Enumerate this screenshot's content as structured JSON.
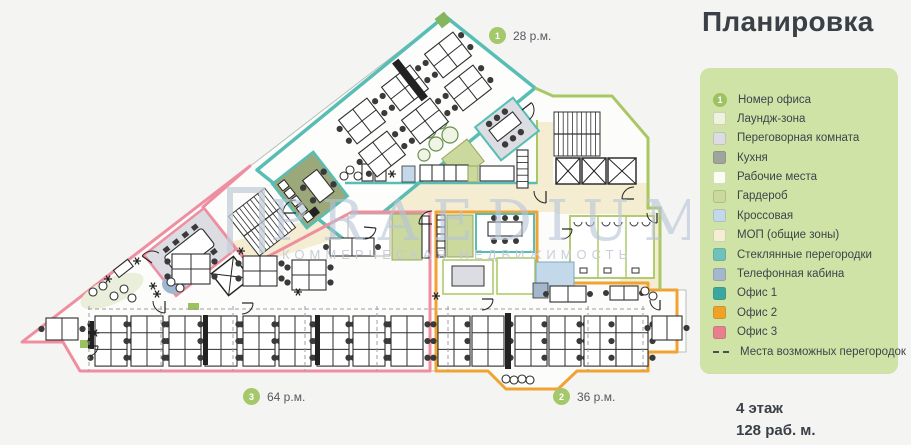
{
  "title": "Планировка",
  "floor_info": {
    "floor": "4 этаж",
    "capacity": "128 раб. м."
  },
  "plan_labels": [
    {
      "num": "1",
      "text": "28 р.м."
    },
    {
      "num": "2",
      "text": "36 р.м."
    },
    {
      "num": "3",
      "text": "64 р.м."
    }
  ],
  "watermark": {
    "brand": "PRAEDIUM",
    "tagline": "КОММЕРЧЕСКАЯ НЕДВИЖИМОСТЬ"
  },
  "colors": {
    "office1_teal": "#57bdb5",
    "office2_orange": "#f0a233",
    "office3_pink": "#ef8ea0",
    "core_green": "#a9c763",
    "corridor_beige": "#f5edd2",
    "legend_bg": "#cee3a5",
    "badge_green": "#a5c86b",
    "text_dark": "#3a4046"
  },
  "legend": {
    "items": [
      {
        "type": "circle",
        "color": "#9dc163",
        "text": "1",
        "label": "Номер офиса"
      },
      {
        "type": "rect",
        "color": "#eef3dd",
        "label": "Лаундж-зона"
      },
      {
        "type": "rect",
        "color": "#dcdde2",
        "label": "Переговорная комната"
      },
      {
        "type": "rect",
        "color": "#9fa49c",
        "label": "Кухня"
      },
      {
        "type": "rect",
        "color": "#fcfdf1",
        "label": "Рабочие места"
      },
      {
        "type": "rect",
        "color": "#cbd89e",
        "label": "Гардероб"
      },
      {
        "type": "rect",
        "color": "#c3d9e9",
        "label": "Кроссовая"
      },
      {
        "type": "rect",
        "color": "#f3eed4",
        "label": "МОП (общие зоны)"
      },
      {
        "type": "rect",
        "color": "#6fc2bc",
        "label": "Стеклянные перегородки"
      },
      {
        "type": "rect",
        "color": "#a4b7cd",
        "label": "Телефонная кабина"
      },
      {
        "type": "rect",
        "color": "#3ca79e",
        "label": "Офис 1"
      },
      {
        "type": "rect",
        "color": "#f0a227",
        "label": "Офис 2"
      },
      {
        "type": "rect",
        "color": "#e87e8e",
        "label": "Офис 3"
      },
      {
        "type": "dash",
        "color": "#4a4f55",
        "label": "Места возможных перегородок"
      }
    ]
  }
}
